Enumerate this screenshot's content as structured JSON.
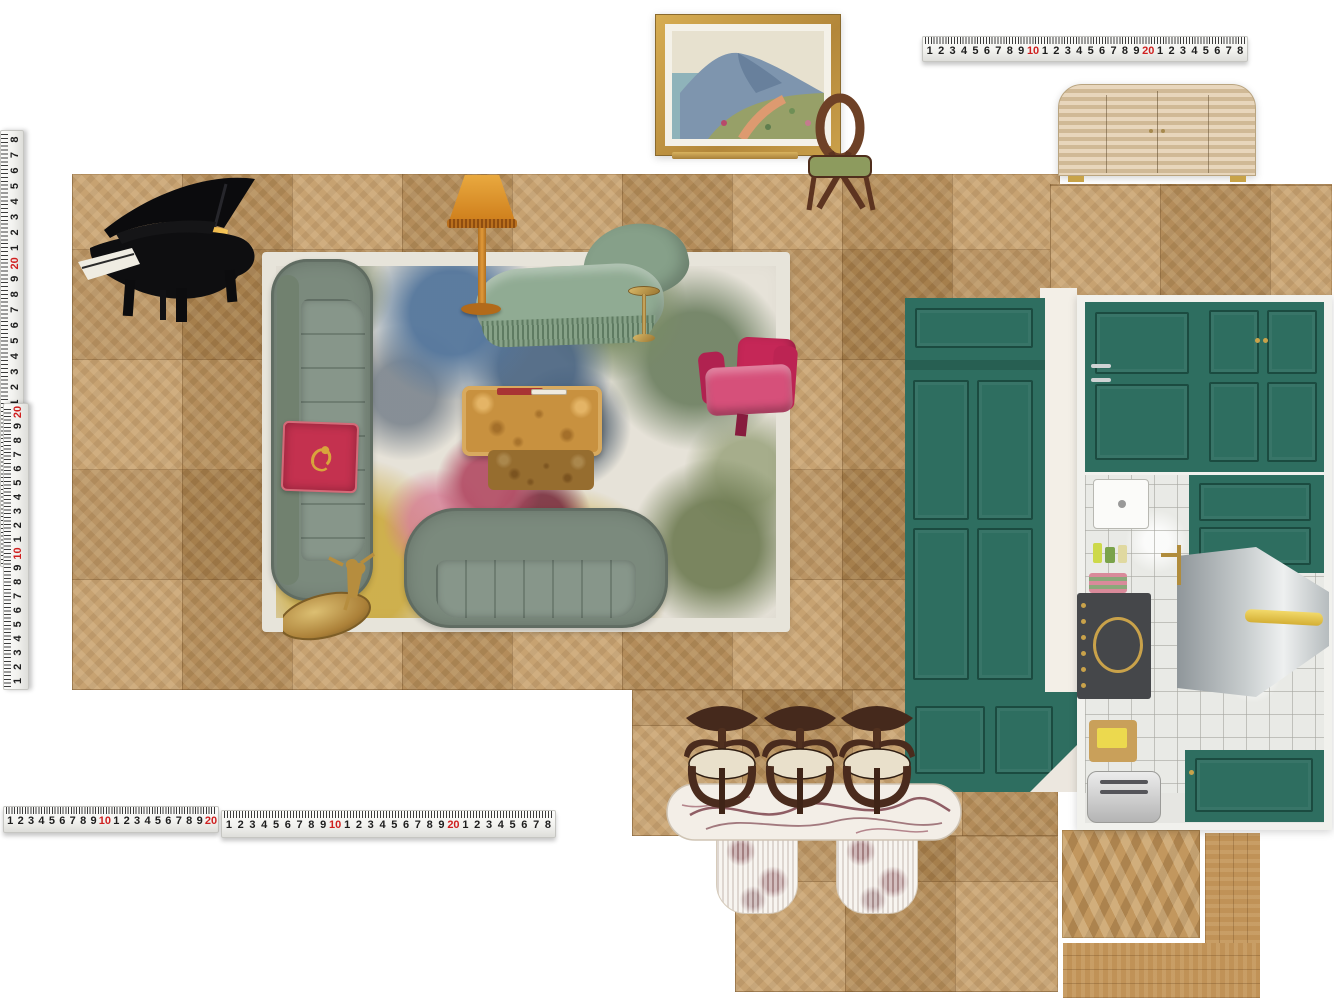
{
  "scene": {
    "type": "interior-design-floor-plan-moodboard",
    "background": "#ffffff"
  },
  "palette": {
    "floor_oak": "#bd9157",
    "rug_cream": "#e6e2d8",
    "sofa_sage": "#7b8a7d",
    "chaise_sage": "#8fa992",
    "armchair_magenta": "#c8295a",
    "cushion_red": "#c4314f",
    "cabinet_teal": "#2e6e60",
    "lamp_mustard": "#d6912c",
    "piano_black": "#0e0e10",
    "marble_white": "#f3eee7",
    "marble_vein": "#6d2c38",
    "brass": "#b5913f",
    "chair_wood_brown": "#4a2b1d",
    "seat_cream": "#e9e0cb",
    "ruler_number_black": "#1d1d1d",
    "ruler_number_red": "#cf1f1f",
    "tile_white": "#e9eae6"
  },
  "rulers": {
    "red_values": [
      "10",
      "20"
    ],
    "top_right": {
      "labels": [
        "1",
        "2",
        "3",
        "4",
        "5",
        "6",
        "7",
        "8",
        "9",
        "10",
        "1",
        "2",
        "3",
        "4",
        "5",
        "6",
        "7",
        "8",
        "9",
        "20",
        "1",
        "2",
        "3",
        "4",
        "5",
        "6",
        "7",
        "8"
      ]
    },
    "left_upper": {
      "labels": [
        "1",
        "2",
        "3",
        "4",
        "5",
        "6",
        "7",
        "8",
        "9",
        "10",
        "1",
        "2",
        "3",
        "4",
        "5",
        "6",
        "7",
        "8",
        "9",
        "20",
        "1",
        "2",
        "3",
        "4",
        "5",
        "6",
        "7",
        "8"
      ]
    },
    "left_lower": {
      "labels": [
        "1",
        "2",
        "3",
        "4",
        "5",
        "6",
        "7",
        "8",
        "9",
        "10",
        "1",
        "2",
        "3",
        "4",
        "5",
        "6",
        "7",
        "8",
        "9",
        "20"
      ]
    },
    "bottom_first": {
      "labels": [
        "1",
        "2",
        "3",
        "4",
        "5",
        "6",
        "7",
        "8",
        "9",
        "10",
        "1",
        "2",
        "3",
        "4",
        "5",
        "6",
        "7",
        "8",
        "9",
        "20"
      ]
    },
    "bottom_second": {
      "labels": [
        "1",
        "2",
        "3",
        "4",
        "5",
        "6",
        "7",
        "8",
        "9",
        "10",
        "1",
        "2",
        "3",
        "4",
        "5",
        "6",
        "7",
        "8",
        "9",
        "20",
        "1",
        "2",
        "3",
        "4",
        "5",
        "6",
        "7",
        "8"
      ]
    }
  },
  "objects": [
    {
      "name": "grand-piano"
    },
    {
      "name": "floral-area-rug"
    },
    {
      "name": "velvet-sofa-vertical"
    },
    {
      "name": "velvet-sofa-horizontal"
    },
    {
      "name": "tiger-throw-cushion"
    },
    {
      "name": "fringed-chaise-lounge"
    },
    {
      "name": "mustard-floor-lamp"
    },
    {
      "name": "brass-drinks-table"
    },
    {
      "name": "burl-coffee-table"
    },
    {
      "name": "magenta-armchair"
    },
    {
      "name": "brass-figural-side-table"
    },
    {
      "name": "framed-landscape-painting"
    },
    {
      "name": "leaning-frame-edge"
    },
    {
      "name": "wooden-loop-chair"
    },
    {
      "name": "ribbed-credenza"
    },
    {
      "name": "teal-cabinet-photo"
    },
    {
      "name": "teal-kitchen-photo"
    },
    {
      "name": "dining-chair"
    },
    {
      "name": "dining-chair"
    },
    {
      "name": "dining-chair"
    },
    {
      "name": "marble-dining-table"
    },
    {
      "name": "chevron-floor-swatch"
    },
    {
      "name": "plank-floor-swatch"
    }
  ]
}
